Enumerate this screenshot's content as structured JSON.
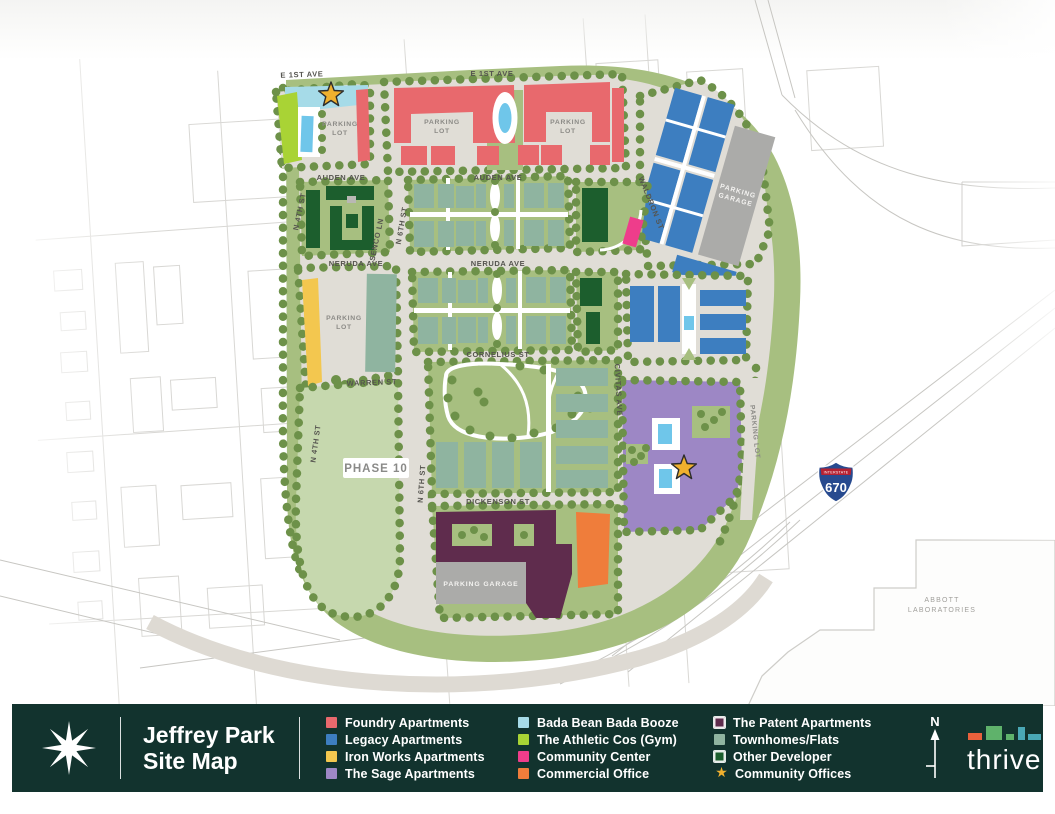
{
  "colors": {
    "bar_bg": "#12332E",
    "foundry": "#E8696D",
    "legacy": "#3D7EC0",
    "iron_works": "#F3C74F",
    "sage": "#9D87C5",
    "bada_bean": "#A6DBE8",
    "athletic": "#A9D335",
    "community_center": "#EE3D8B",
    "commercial": "#EF7D3B",
    "patent": "#5F2C4D",
    "townhomes": "#8FB4A0",
    "other_developer": "#1C5E2D",
    "community_offices_star": "#F0B02E",
    "site_green": "#A7BF80",
    "tree_green": "#6D9149",
    "phase_green": "#C6D8AE",
    "road_gray": "#E0DDD6",
    "garage_gray": "#ABABA9",
    "pool_blue": "#6FC6EA",
    "shield_blue": "#274A8F",
    "shield_red": "#B52132"
  },
  "icons": {
    "star": "★"
  },
  "map": {
    "streets": {
      "e_1st_ave": "E 1ST AVE",
      "auden_ave": "AUDEN AVE",
      "neruda_ave": "NERUDA AVE",
      "cornelius_st": "CORNELIUS ST",
      "warren_st": "WARREN ST",
      "dickenson_st": "DICKENSON ST",
      "n_4th_st": "N 4TH ST",
      "n_6th_st": "N 6TH ST",
      "senco_ln": "SENCO LN",
      "waldron_st": "WALDRON ST",
      "civitas_ave": "CIVITAS AVE"
    },
    "labels": {
      "parking": "PARKING",
      "lot": "LOT",
      "garage": "GARAGE",
      "parking_lot": "PARKING LOT",
      "parking_garage": "PARKING GARAGE",
      "phase_10": "PHASE 10",
      "abbott": "ABBOTT",
      "laboratories": "LABORATORIES",
      "interstate": "INTERSTATE",
      "route_670": "670"
    }
  },
  "legend": {
    "title_line1": "Jeffrey Park",
    "title_line2": "Site Map",
    "columns": [
      [
        {
          "label": "Foundry Apartments"
        },
        {
          "label": "Legacy Apartments"
        },
        {
          "label": "Iron Works Apartments"
        },
        {
          "label": "The Sage Apartments"
        }
      ],
      [
        {
          "label": "Bada Bean Bada Booze"
        },
        {
          "label": "The Athletic Cos (Gym)"
        },
        {
          "label": "Community Center"
        },
        {
          "label": "Commercial Office"
        }
      ],
      [
        {
          "label": "The Patent Apartments"
        },
        {
          "label": "Townhomes/Flats"
        },
        {
          "label": "Other Developer"
        },
        {
          "label": "Community Offices"
        }
      ]
    ],
    "compass_n": "N",
    "brand": "thrive"
  }
}
